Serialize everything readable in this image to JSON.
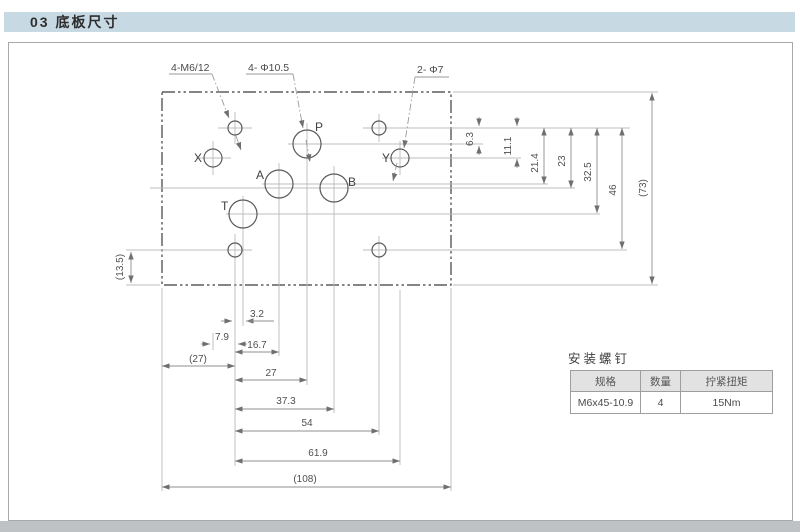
{
  "header": {
    "title": "03 底板尺寸"
  },
  "drawing": {
    "callouts": {
      "m6": "4-M6/12",
      "phi105": "4- Φ10.5",
      "phi7": "2- Φ7"
    },
    "ports": {
      "P": "P",
      "A": "A",
      "B": "B",
      "T": "T",
      "X": "X",
      "Y": "Y"
    },
    "dims": {
      "right": {
        "d1": "6.3",
        "d2": "11.1",
        "d3": "21.4",
        "d4": "23",
        "d5": "32.5",
        "d6": "46",
        "d7": "(73)"
      },
      "bottom": {
        "b1": "3.2",
        "b2": "7.9",
        "b3": "16.7",
        "b4": "(27)",
        "b5": "27",
        "b6": "37.3",
        "b7": "54",
        "b8": "61.9",
        "b9": "(108)"
      },
      "left": {
        "l1": "(13.5)"
      }
    }
  },
  "table": {
    "title": "安装螺钉",
    "headers": [
      "规格",
      "数量",
      "拧紧扭矩"
    ],
    "rows": [
      [
        "M6x45-10.9",
        "4",
        "15Nm"
      ]
    ]
  }
}
